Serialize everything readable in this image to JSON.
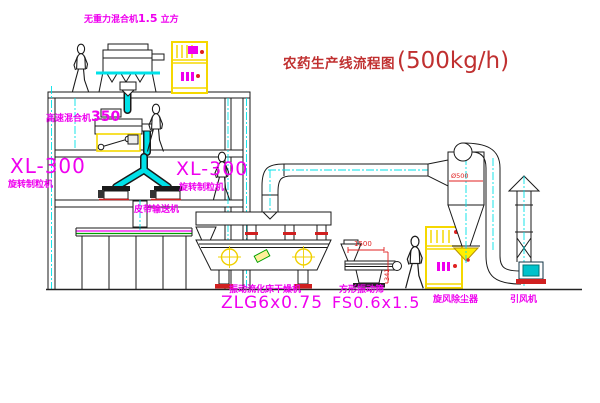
{
  "title": {
    "main": "农药生产线流程图",
    "capacity": "(500kg/h)"
  },
  "equipment": {
    "gravity_mixer": {
      "name": "无重力混合机",
      "size": "1.5",
      "unit": "立方"
    },
    "high_speed_mixer": {
      "name": "高速混合机",
      "size": "350"
    },
    "granulator_left": {
      "model": "XL-300",
      "name": "旋转制粒机"
    },
    "granulator_right": {
      "model": "XL-300",
      "name": "旋转制粒机"
    },
    "belt_conveyor": {
      "name": "皮带输送机"
    },
    "dryer": {
      "name": "振动流化床干燥机",
      "model": "ZLG6x0.75"
    },
    "screen": {
      "name": "方形振动筛",
      "model": "FS0.6x1.5"
    },
    "cyclone": {
      "name": "旋风除尘器"
    },
    "fan": {
      "name": "引风机"
    }
  },
  "dimensions": {
    "screen_length": "1500",
    "screen_height": "341",
    "cyclone_inlet": "Ø500"
  },
  "colors": {
    "line": "#1a1a1a",
    "centerline_cyan": "#00e1e8",
    "label_magenta": "#ef00ef",
    "annotation_red": "#e02020",
    "title_red": "#c03030",
    "highlight_yellow": "#ffef00",
    "belt_green": "#00a000",
    "fan_teal": "#00c2cb"
  }
}
